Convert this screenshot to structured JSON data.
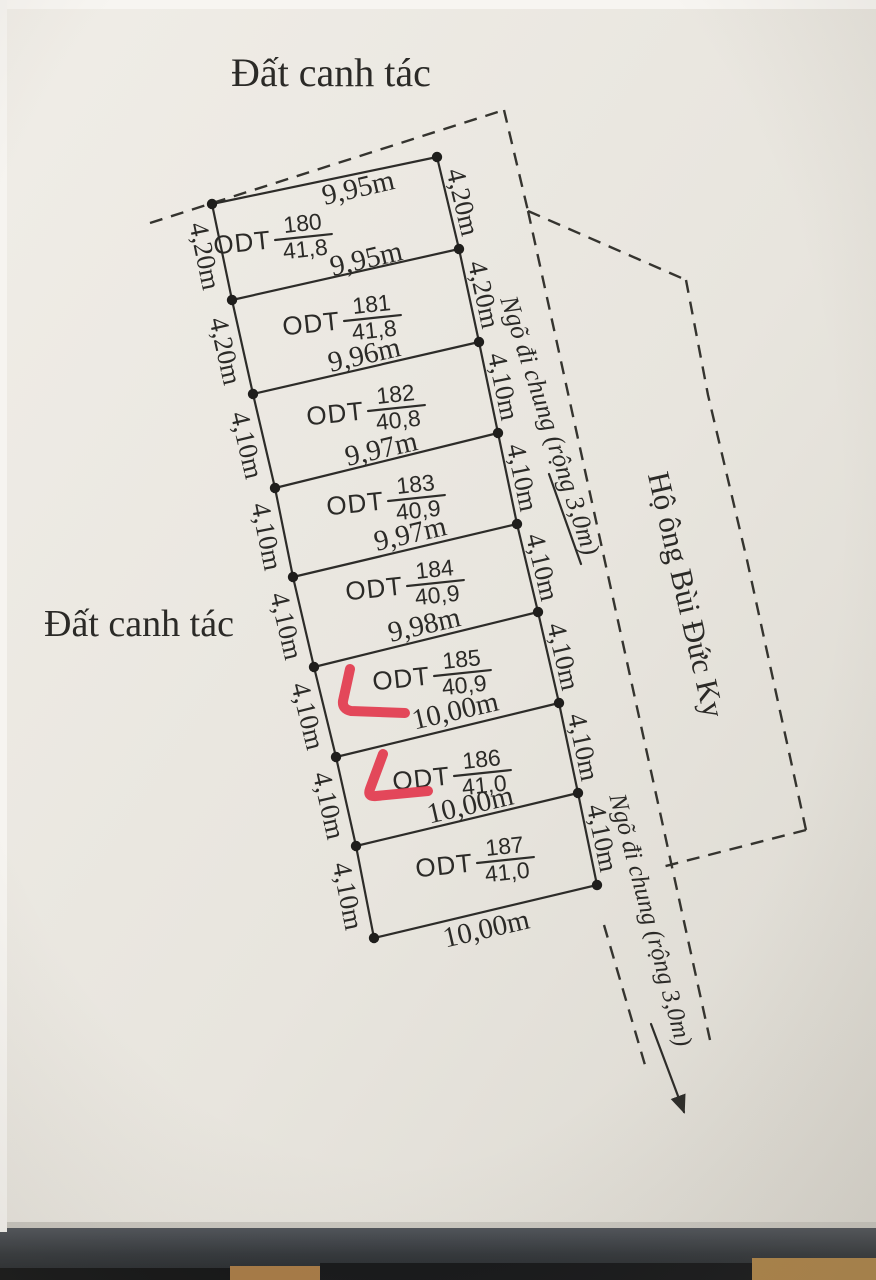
{
  "diagram": {
    "title_top": "Đất canh tác",
    "label_left": "Đất canh tác",
    "alley_top_label": "Ngõ đi chung (rộng 3,0m)",
    "alley_bottom_label": "Ngõ đi chung (rộng 3,0m)",
    "neighbor_label": "Hộ ông Bùi Đức Ky",
    "edge_widths": [
      "9,95m",
      "9,95m",
      "9,96m",
      "9,97m",
      "9,97m",
      "9,98m",
      "10,00m",
      "10,00m",
      "10,00m"
    ],
    "parcels": [
      {
        "code": "ODT",
        "id": "180",
        "area": "41,8",
        "left": "4,20m",
        "right": "4,20m"
      },
      {
        "code": "ODT",
        "id": "181",
        "area": "41,8",
        "left": "4,20m",
        "right": "4,20m"
      },
      {
        "code": "ODT",
        "id": "182",
        "area": "40,8",
        "left": "4,10m",
        "right": "4,10m"
      },
      {
        "code": "ODT",
        "id": "183",
        "area": "40,9",
        "left": "4,10m",
        "right": "4,10m"
      },
      {
        "code": "ODT",
        "id": "184",
        "area": "40,9",
        "left": "4,10m",
        "right": "4,10m"
      },
      {
        "code": "ODT",
        "id": "185",
        "area": "40,9",
        "left": "4,10m",
        "right": "4,10m"
      },
      {
        "code": "ODT",
        "id": "186",
        "area": "41,0",
        "left": "4,10m",
        "right": "4,10m"
      },
      {
        "code": "ODT",
        "id": "187",
        "area": "41,0",
        "left": "4,10m",
        "right": "4,10m"
      }
    ],
    "red_marks": {
      "color": "#e23b50",
      "count": 2,
      "near_parcels": [
        "185",
        "186"
      ]
    }
  }
}
